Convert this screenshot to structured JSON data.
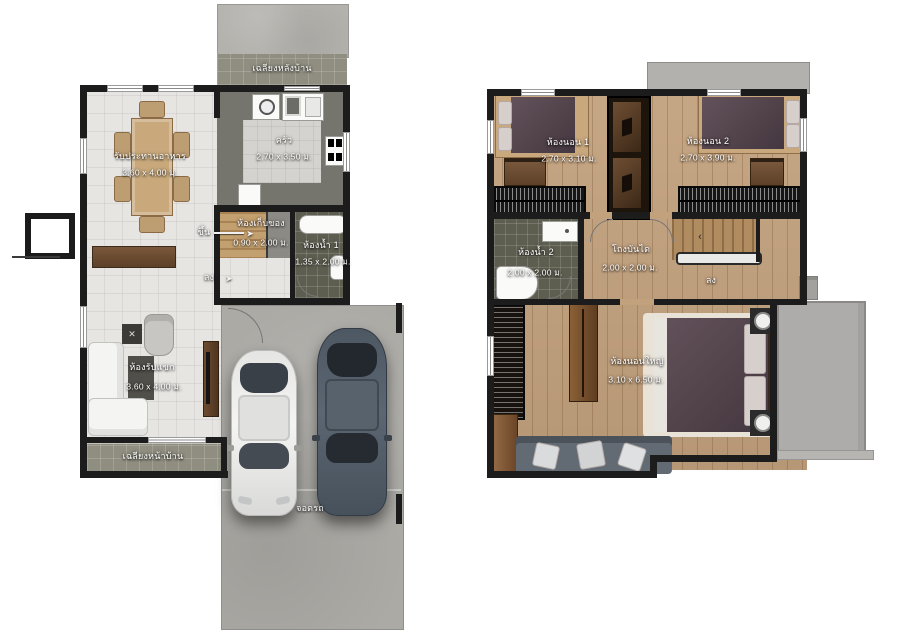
{
  "document_type": "two-storey house floor plan",
  "floor1": {
    "back_porch_label": "เฉลียงหลังบ้าน",
    "dining": {
      "name": "รับประทานอาหาร",
      "dims": "3.60 x 4.00 ม."
    },
    "kitchen": {
      "name": "ครัว",
      "dims": "2.70 x 3.50 ม."
    },
    "storage": {
      "name": "ห้องเก็บของ",
      "dims": "0.90 x 2.00 ม."
    },
    "bath1": {
      "name": "ห้องน้ำ 1",
      "dims": "1.35 x 2.00 ม."
    },
    "living": {
      "name": "ห้องรับแขก",
      "dims": "3.60 x 4.00 ม."
    },
    "front_porch_label": "เฉลียงหน้าบ้าน",
    "garage_label": "จอดรถ",
    "stairs_up_label": "ขึ้น",
    "stairs_down_label": "ลง"
  },
  "floor2": {
    "bedroom1": {
      "name": "ห้องนอน 1",
      "dims": "2.70 x 3.10 ม."
    },
    "bedroom2": {
      "name": "ห้องนอน 2",
      "dims": "2.70 x 3.90 ม."
    },
    "bath2": {
      "name": "ห้องน้ำ 2",
      "dims": "2.00 x 2.00 ม."
    },
    "hall": {
      "name": "โถงบันได",
      "dims": "2.00 x 2.00 ม."
    },
    "master": {
      "name": "ห้องนอนใหญ่",
      "dims": "3.10 x 6.50 ม."
    },
    "stairs_down_label": "ลง"
  },
  "icons": {
    "arrow_right": "➤",
    "arrow_left": "‹",
    "cross_mark": "✕"
  },
  "colors": {
    "wall": "#1c1c1c",
    "tile_light": "#e6e5e2",
    "kitchen_counter": "#75746d",
    "bath_tile": "#5e5e50",
    "porch_tile": "#908e80",
    "concrete": "#b4b2ad",
    "wood_floor": "#c2a17d",
    "duvet": "#584850",
    "sofa": "#626a73",
    "car_white": "#ededeb",
    "car_dark": "#55606c",
    "balcony": "#aeacaa"
  }
}
